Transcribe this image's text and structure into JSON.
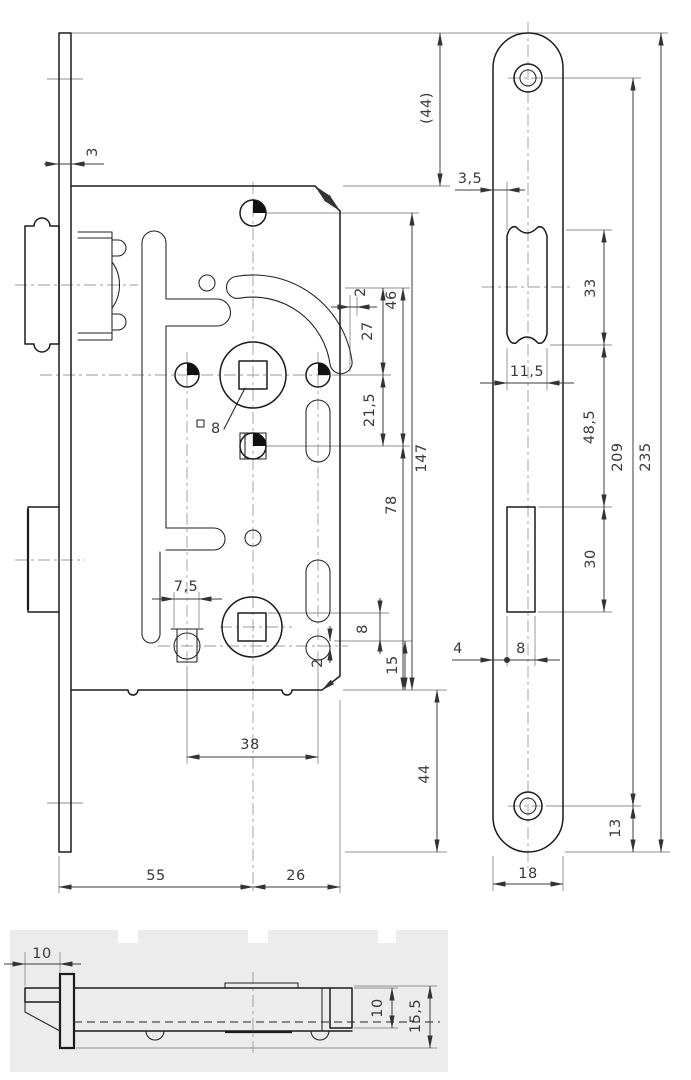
{
  "drawing": {
    "kind": "technical drawing",
    "subject": "mortise door lock, three orthographic views",
    "colors": {
      "line": "#1b1b1b",
      "dimension": "#3d3d3d",
      "extension": "#8f8f8f",
      "centerline": "#9b9b9b",
      "bottom_panel": "#ececec",
      "background": "#ffffff"
    }
  },
  "dims": {
    "lv_3": "3",
    "lv_44_aux": "(44)",
    "lv_2_top": "2",
    "lv_46": "46",
    "lv_27": "27",
    "lv_21_5": "21,5",
    "lv_147": "147",
    "lv_78": "78",
    "lv_square_8": "8",
    "lv_7_5": "7,5",
    "lv_8": "8",
    "lv_2_low": "2",
    "lv_15": "15",
    "lv_38": "38",
    "lv_44": "44",
    "lv_55": "55",
    "lv_26": "26",
    "rv_3_5": "3,5",
    "rv_33": "33",
    "rv_11_5": "11,5",
    "rv_48_5": "48,5",
    "rv_209": "209",
    "rv_235": "235",
    "rv_30": "30",
    "rv_4": "4",
    "rv_8": "8",
    "rv_13": "13",
    "rv_18": "18",
    "bv_10_left": "10",
    "bv_10_right": "10",
    "bv_15_5": "15,5"
  }
}
